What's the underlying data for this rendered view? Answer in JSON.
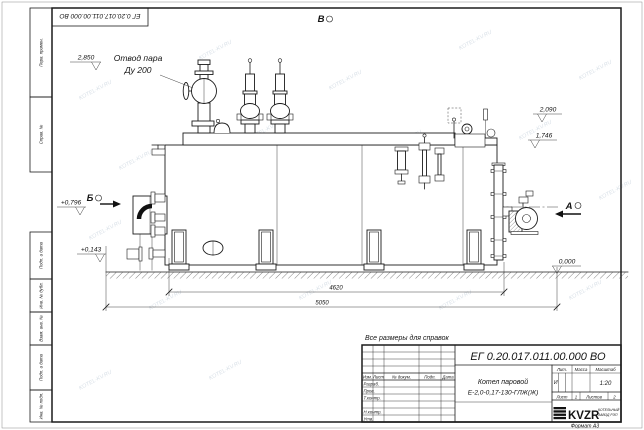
{
  "sheet": {
    "background": "#ffffff",
    "line_color": "#1b1b1b",
    "watermark": "KOTEL-KV.RU",
    "doc_number": "ЕГ 0.20.017.011.00.000 ВО",
    "format_label": "Формат А3",
    "note_reference_dims": "Все размеры для справок"
  },
  "frame": {
    "margin_labels_top": [
      "Перв. примен.",
      "Справ. №"
    ],
    "margin_labels_bottom": [
      "Подп. и дата",
      "Инв. № дубл.",
      "Взам. инв. №",
      "Подп. и дата",
      "Инв. № подл."
    ]
  },
  "title_block": {
    "product_line1": "Котел паровой",
    "product_line2": "Е-2,0-0,17-130-ГЛЖ(Ж)",
    "col_izm": "Изм.",
    "col_list": "Лист",
    "col_doc": "№ докум.",
    "col_sign": "Подп.",
    "col_date": "Дата",
    "col_lit": "Лит.",
    "col_mass": "Масса",
    "col_scale": "Масштаб",
    "sig_rows": [
      "Разраб.",
      "Пров.",
      "Т.контр.",
      "Н.контр.",
      "Утв."
    ],
    "lit_value": "И",
    "scale_value": "1:20",
    "sheet_label": "Лист",
    "sheet_value": "1",
    "sheets_label": "Листов",
    "sheets_value": "2",
    "company_logo": "KVZR",
    "company_line1": "КОТЕЛЬНЫЙ",
    "company_line2": "ЗАВОД РЭП"
  },
  "annotations": {
    "steam_outlet_line1": "Отвод пара",
    "steam_outlet_line2": "Ду 200",
    "view_top": "В",
    "view_left": "Б",
    "view_right": "А",
    "elev_steam_outlet": "2,850",
    "elev_top_right": "2,090",
    "elev_mid_right": "1,746",
    "elev_burner": "+0,796",
    "elev_low_left": "+0,143",
    "elev_ground": "0,000",
    "dim_supports": "4620",
    "dim_overall": "5050"
  }
}
